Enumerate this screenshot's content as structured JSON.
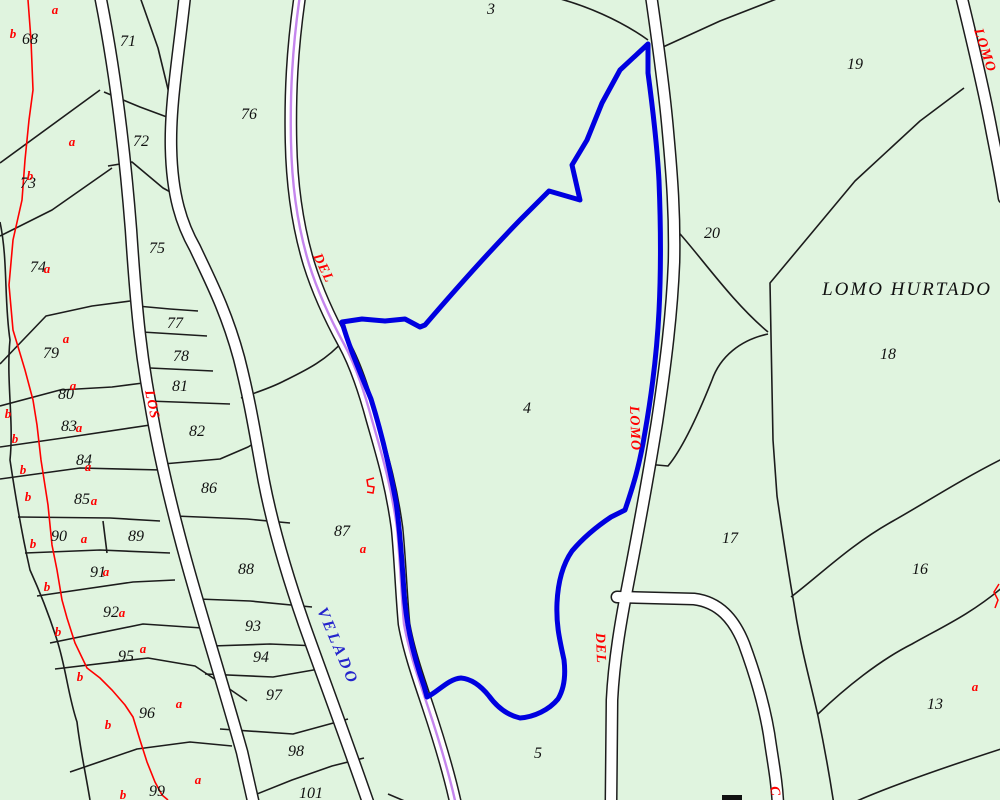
{
  "map": {
    "area_label": {
      "t": "LOMO HURTADO",
      "x": 907,
      "y": 295
    },
    "selected_parcel": "4",
    "colors": {
      "background": "#e0f4df",
      "boundary": "#1c1c1c",
      "selection_blue": "#0000e0",
      "road_fill": "#ffffff",
      "road_centerline_violet": "#c586ee",
      "subparcel_red": "#ff0000",
      "road_label_blue": "#2424cc"
    },
    "parcel_numbers": [
      {
        "n": "3",
        "x": 491,
        "y": 14
      },
      {
        "n": "4",
        "x": 527,
        "y": 413
      },
      {
        "n": "5",
        "x": 538,
        "y": 758
      },
      {
        "n": "13",
        "x": 935,
        "y": 709
      },
      {
        "n": "16",
        "x": 920,
        "y": 574
      },
      {
        "n": "17",
        "x": 730,
        "y": 543
      },
      {
        "n": "18",
        "x": 888,
        "y": 359
      },
      {
        "n": "19",
        "x": 855,
        "y": 69
      },
      {
        "n": "20",
        "x": 712,
        "y": 238
      },
      {
        "n": "68",
        "x": 30,
        "y": 44
      },
      {
        "n": "71",
        "x": 128,
        "y": 46
      },
      {
        "n": "72",
        "x": 141,
        "y": 146
      },
      {
        "n": "73",
        "x": 28,
        "y": 188
      },
      {
        "n": "74",
        "x": 38,
        "y": 272
      },
      {
        "n": "75",
        "x": 157,
        "y": 253
      },
      {
        "n": "76",
        "x": 249,
        "y": 119
      },
      {
        "n": "77",
        "x": 175,
        "y": 328
      },
      {
        "n": "78",
        "x": 181,
        "y": 361
      },
      {
        "n": "79",
        "x": 51,
        "y": 358
      },
      {
        "n": "80",
        "x": 66,
        "y": 399
      },
      {
        "n": "81",
        "x": 180,
        "y": 391
      },
      {
        "n": "82",
        "x": 197,
        "y": 436
      },
      {
        "n": "83",
        "x": 69,
        "y": 431
      },
      {
        "n": "84",
        "x": 84,
        "y": 465
      },
      {
        "n": "85",
        "x": 82,
        "y": 504
      },
      {
        "n": "86",
        "x": 209,
        "y": 493
      },
      {
        "n": "87",
        "x": 342,
        "y": 536
      },
      {
        "n": "88",
        "x": 246,
        "y": 574
      },
      {
        "n": "89",
        "x": 136,
        "y": 541
      },
      {
        "n": "90",
        "x": 59,
        "y": 541
      },
      {
        "n": "91",
        "x": 98,
        "y": 577
      },
      {
        "n": "92",
        "x": 111,
        "y": 617
      },
      {
        "n": "93",
        "x": 253,
        "y": 631
      },
      {
        "n": "94",
        "x": 261,
        "y": 662
      },
      {
        "n": "95",
        "x": 126,
        "y": 661
      },
      {
        "n": "96",
        "x": 147,
        "y": 718
      },
      {
        "n": "97",
        "x": 274,
        "y": 700
      },
      {
        "n": "98",
        "x": 296,
        "y": 756
      },
      {
        "n": "99",
        "x": 157,
        "y": 796
      },
      {
        "n": "101",
        "x": 311,
        "y": 798
      }
    ],
    "subparcel_letters": [
      {
        "t": "a",
        "x": 55,
        "y": 14
      },
      {
        "t": "b",
        "x": 13,
        "y": 38
      },
      {
        "t": "a",
        "x": 72,
        "y": 146
      },
      {
        "t": "b",
        "x": 30,
        "y": 180
      },
      {
        "t": "a",
        "x": 47,
        "y": 273
      },
      {
        "t": "a",
        "x": 66,
        "y": 343
      },
      {
        "t": "a",
        "x": 73,
        "y": 390
      },
      {
        "t": "b",
        "x": 8,
        "y": 418
      },
      {
        "t": "a",
        "x": 79,
        "y": 432
      },
      {
        "t": "b",
        "x": 15,
        "y": 443
      },
      {
        "t": "a",
        "x": 88,
        "y": 471
      },
      {
        "t": "b",
        "x": 23,
        "y": 474
      },
      {
        "t": "b",
        "x": 28,
        "y": 501
      },
      {
        "t": "a",
        "x": 94,
        "y": 505
      },
      {
        "t": "a",
        "x": 84,
        "y": 543
      },
      {
        "t": "b",
        "x": 33,
        "y": 548
      },
      {
        "t": "a",
        "x": 106,
        "y": 576
      },
      {
        "t": "b",
        "x": 47,
        "y": 591
      },
      {
        "t": "a",
        "x": 122,
        "y": 617
      },
      {
        "t": "b",
        "x": 58,
        "y": 636
      },
      {
        "t": "a",
        "x": 143,
        "y": 653
      },
      {
        "t": "b",
        "x": 80,
        "y": 681
      },
      {
        "t": "a",
        "x": 179,
        "y": 708
      },
      {
        "t": "b",
        "x": 108,
        "y": 729
      },
      {
        "t": "b",
        "x": 123,
        "y": 799
      },
      {
        "t": "a",
        "x": 198,
        "y": 784
      },
      {
        "t": "a",
        "x": 363,
        "y": 553
      },
      {
        "t": "a",
        "x": 975,
        "y": 691
      }
    ],
    "road_labels": [
      {
        "t": "DEL",
        "x": 313,
        "y": 256,
        "r": 64,
        "c": "red",
        "ls": 1
      },
      {
        "t": "LOS",
        "x": 145,
        "y": 391,
        "r": 78,
        "c": "red",
        "ls": 1
      },
      {
        "t": "LOMO",
        "x": 630,
        "y": 406,
        "r": 88,
        "c": "red",
        "ls": 1
      },
      {
        "t": "DEL",
        "x": 596,
        "y": 633,
        "r": 88,
        "c": "red",
        "ls": 1
      },
      {
        "t": "LOMO",
        "x": 974,
        "y": 30,
        "r": 72,
        "c": "red",
        "ls": 1
      },
      {
        "t": "C",
        "x": 770,
        "y": 787,
        "r": 80,
        "c": "red",
        "ls": 0
      },
      {
        "t": "VELADO",
        "x": 317,
        "y": 610,
        "r": 67,
        "c": "blue",
        "ls": 3
      }
    ]
  }
}
